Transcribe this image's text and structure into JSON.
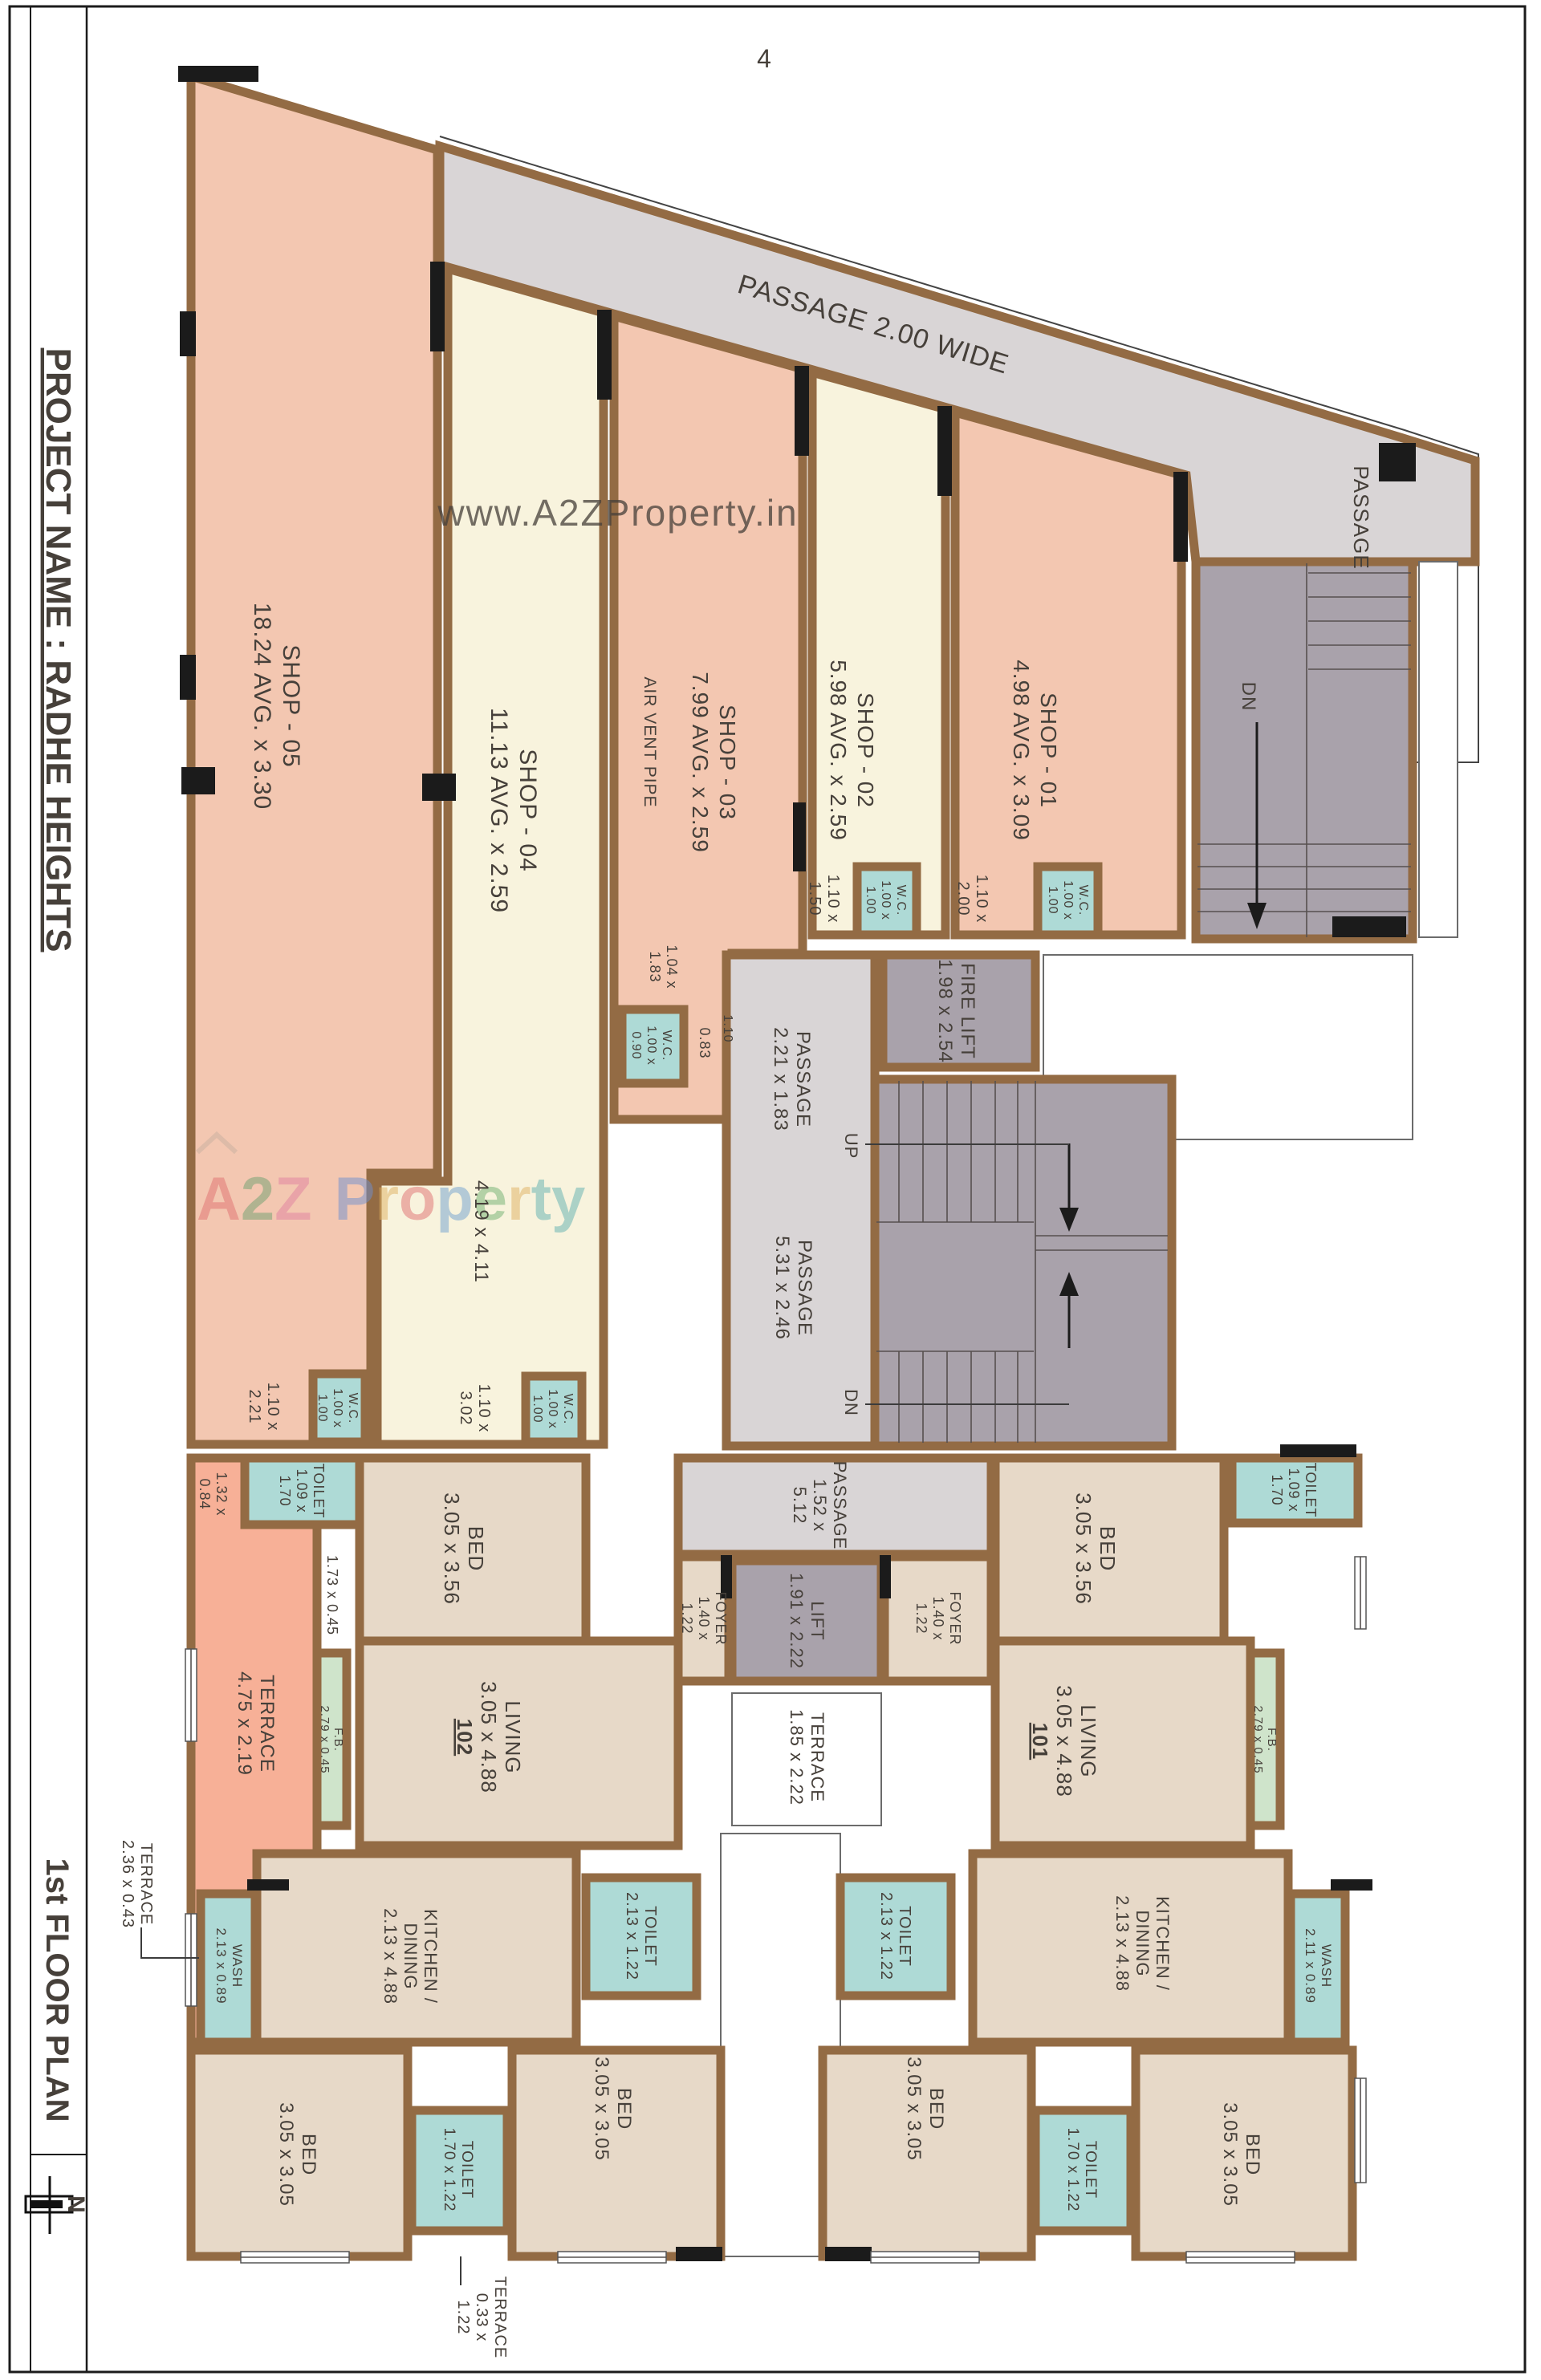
{
  "page": {
    "number": "4"
  },
  "title_block": {
    "project_name": "PROJECT NAME : RADHE HEIGHTS",
    "plan_name": "1st FLOOR PLAN",
    "north": "N"
  },
  "watermarks": {
    "url": "www.A2ZProperty.in",
    "brand_letters": [
      "A",
      "2",
      "Z",
      "P",
      "r",
      "o",
      "p",
      "e",
      "r",
      "t",
      "y"
    ]
  },
  "colors": {
    "shop_pink": "#f3c7b1",
    "shop_cream": "#f8f3dd",
    "room_beige": "#e7d9c8",
    "wet_teal": "#aedad6",
    "terrace_salmon": "#f7b097",
    "fb_green": "#cfe4cb",
    "stair_gray": "#a9a2ab",
    "passage_gray": "#d9d5d6",
    "wall_brown": "#936b44",
    "ink": "#46403a"
  },
  "labels": {
    "passage_top": [
      "PASSAGE 2.00 WIDE"
    ],
    "passage_right": [
      "PASSAGE"
    ],
    "dn_top": [
      "DN"
    ],
    "shop05": [
      "SHOP - 05",
      "18.24 AVG. x 3.30"
    ],
    "shop04": [
      "SHOP - 04",
      "11.13 AVG. x 2.59"
    ],
    "shop03": [
      "SHOP - 03",
      "7.99 AVG. x 2.59"
    ],
    "air_vent": [
      "AIR VENT PIPE"
    ],
    "shop02": [
      "SHOP - 02",
      "5.98 AVG. x 2.59"
    ],
    "shop01": [
      "SHOP - 01",
      "4.98 AVG. x 3.09"
    ],
    "door_shop05": [
      "1.10 x",
      "2.21"
    ],
    "wc_shop05": [
      "W.C.",
      "1.00 x",
      "1.00"
    ],
    "door_shop04": [
      "1.10 x",
      "3.02"
    ],
    "wc_shop04": [
      "W.C.",
      "1.00 x",
      "1.00"
    ],
    "inner_shop04": [
      "4.19 x 4.11"
    ],
    "door_shop03": [
      "1.04 x",
      "1.83"
    ],
    "wc_shop03": [
      "W.C.",
      "1.00 x",
      "0.90"
    ],
    "dim_083": [
      "0.83"
    ],
    "dim_110": [
      "1.10"
    ],
    "door_shop02": [
      "1.10 x",
      "1.50"
    ],
    "wc_shop02": [
      "W.C.",
      "1.00 x",
      "1.00"
    ],
    "door_shop01": [
      "1.10 x",
      "2.00"
    ],
    "wc_shop01": [
      "W.C.",
      "1.00 x",
      "1.00"
    ],
    "passage_221": [
      "PASSAGE",
      "2.21 x 1.83"
    ],
    "fire_lift": [
      "FIRE LIFT",
      "1.98 x 2.54"
    ],
    "up": [
      "UP"
    ],
    "dn": [
      "DN"
    ],
    "passage_531": [
      "PASSAGE",
      "5.31 x 2.46"
    ],
    "passage_152": [
      "PASSAGE",
      "1.52 x",
      "5.12"
    ],
    "lift": [
      "LIFT",
      "1.91 x 2.22"
    ],
    "terrace_center": [
      "TERRACE",
      "1.85 x 2.22"
    ],
    "foyer102": [
      "FOYER",
      "1.40 x",
      "1.22"
    ],
    "foyer101": [
      "FOYER",
      "1.40 x",
      "1.22"
    ],
    "dim_132084": [
      "1.32 x",
      "0.84"
    ],
    "toilet102top": [
      "TOILET",
      "1.09 x",
      "1.70"
    ],
    "dim_173045": [
      "1.73 x 0.45"
    ],
    "bed102top": [
      "BED",
      "3.05 x 3.56"
    ],
    "terrace102": [
      "TERRACE",
      "4.75 x 2.19"
    ],
    "fb102": [
      "F.B.",
      "2.79 x 0.45"
    ],
    "living102": [
      "LIVING",
      "3.05 x 4.88",
      "102"
    ],
    "bed101top": [
      "BED",
      "3.05 x 3.56"
    ],
    "toilet101top": [
      "TOILET",
      "1.09 x",
      "1.70"
    ],
    "living101": [
      "LIVING",
      "3.05 x 4.88",
      "101"
    ],
    "fb101": [
      "F.B.",
      "2.79 x 0.45"
    ],
    "terrace_left_note": [
      "TERRACE",
      "2.36 x 0.43"
    ],
    "wash102": [
      "WASH",
      "2.13 x 0.89"
    ],
    "kitchen102": [
      "KITCHEN /",
      "DINING",
      "2.13 x 4.88"
    ],
    "toilet102mid": [
      "TOILET",
      "2.13 x 1.22"
    ],
    "toilet101mid": [
      "TOILET",
      "2.13 x 1.22"
    ],
    "kitchen101": [
      "KITCHEN /",
      "DINING",
      "2.13 x 4.88"
    ],
    "wash101": [
      "WASH",
      "2.11 x 0.89"
    ],
    "bed102bl": [
      "BED",
      "3.05 x 3.05"
    ],
    "toilet102bot": [
      "TOILET",
      "1.70 x 1.22"
    ],
    "bed102bm": [
      "BED",
      "3.05 x 3.05"
    ],
    "bed101bm": [
      "BED",
      "3.05 x 3.05"
    ],
    "toilet101bot": [
      "TOILET",
      "1.70 x 1.22"
    ],
    "bed101br": [
      "BED",
      "3.05 x 3.05"
    ],
    "terrace_bottom_note": [
      "TERRACE",
      "0.33 x",
      "1.22"
    ]
  }
}
